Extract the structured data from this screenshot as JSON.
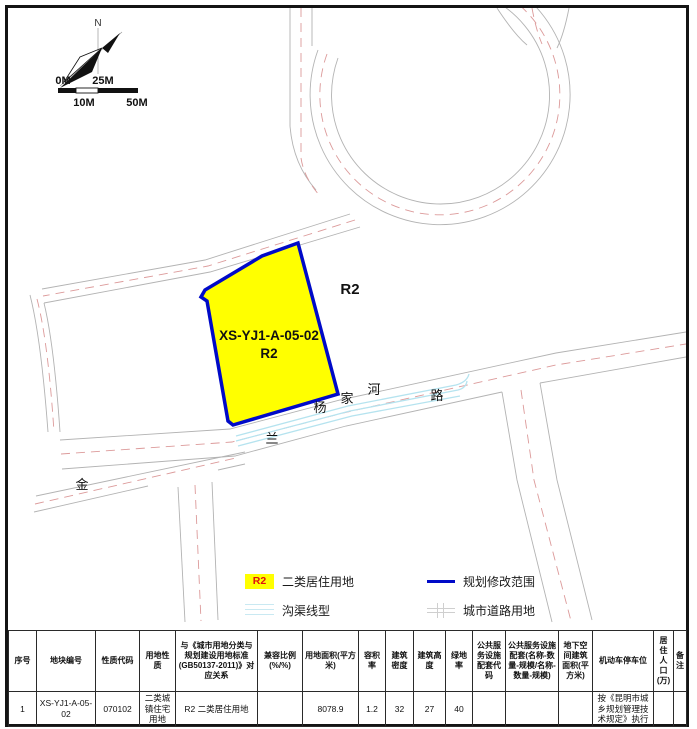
{
  "map": {
    "north_label": "N",
    "scale_bar": {
      "top_labels": [
        "0M",
        "25M"
      ],
      "bottom_labels": [
        "10M",
        "50M"
      ]
    },
    "parcel": {
      "code": "XS-YJ1-A-05-02",
      "zone_code": "R2"
    },
    "adjacent_zone_label": "R2",
    "road_labels": {
      "yangjiahe_road": [
        "杨",
        "家",
        "河",
        "路"
      ],
      "jinlan_road": [
        "金",
        "兰"
      ]
    }
  },
  "legend": {
    "items": [
      {
        "swatch_text": "R2",
        "label": "二类居住用地"
      },
      {
        "label": "规划修改范围"
      },
      {
        "label": "沟渠线型"
      },
      {
        "label": "城市道路用地"
      }
    ]
  },
  "table": {
    "headers": [
      "序号",
      "地块编号",
      "性质代码",
      "用地性质",
      "与《城市用地分类与规划建设用地标准(GB50137-2011)》对应关系",
      "兼容比例(%/%)",
      "用地面积(平方米)",
      "容积率",
      "建筑密度",
      "建筑高度",
      "绿地率",
      "公共服务设施配套代码",
      "公共服务设施配套(名称-数量-规模/名称-数量-规模)",
      "地下空间建筑面积(平方米)",
      "机动车停车位",
      "居 住 人 口 (万)",
      "备注"
    ],
    "rows": [
      [
        "1",
        "XS-YJ1-A-05-02",
        "070102",
        "二类城镇住宅用地",
        "R2 二类居住用地",
        "",
        "8078.9",
        "1.2",
        "32",
        "27",
        "40",
        "",
        "",
        "",
        "按《昆明市城乡规划管理技术规定》执行",
        "",
        ""
      ]
    ]
  },
  "colors": {
    "parcel_fill": "#ffff00",
    "boundary_blue": "#000ac8",
    "ditch_cyan": "#b5e3ef",
    "road_gray": "#b3b3b3",
    "centerline_red": "#dc9a9a",
    "legend_r2_text": "#e01010"
  }
}
